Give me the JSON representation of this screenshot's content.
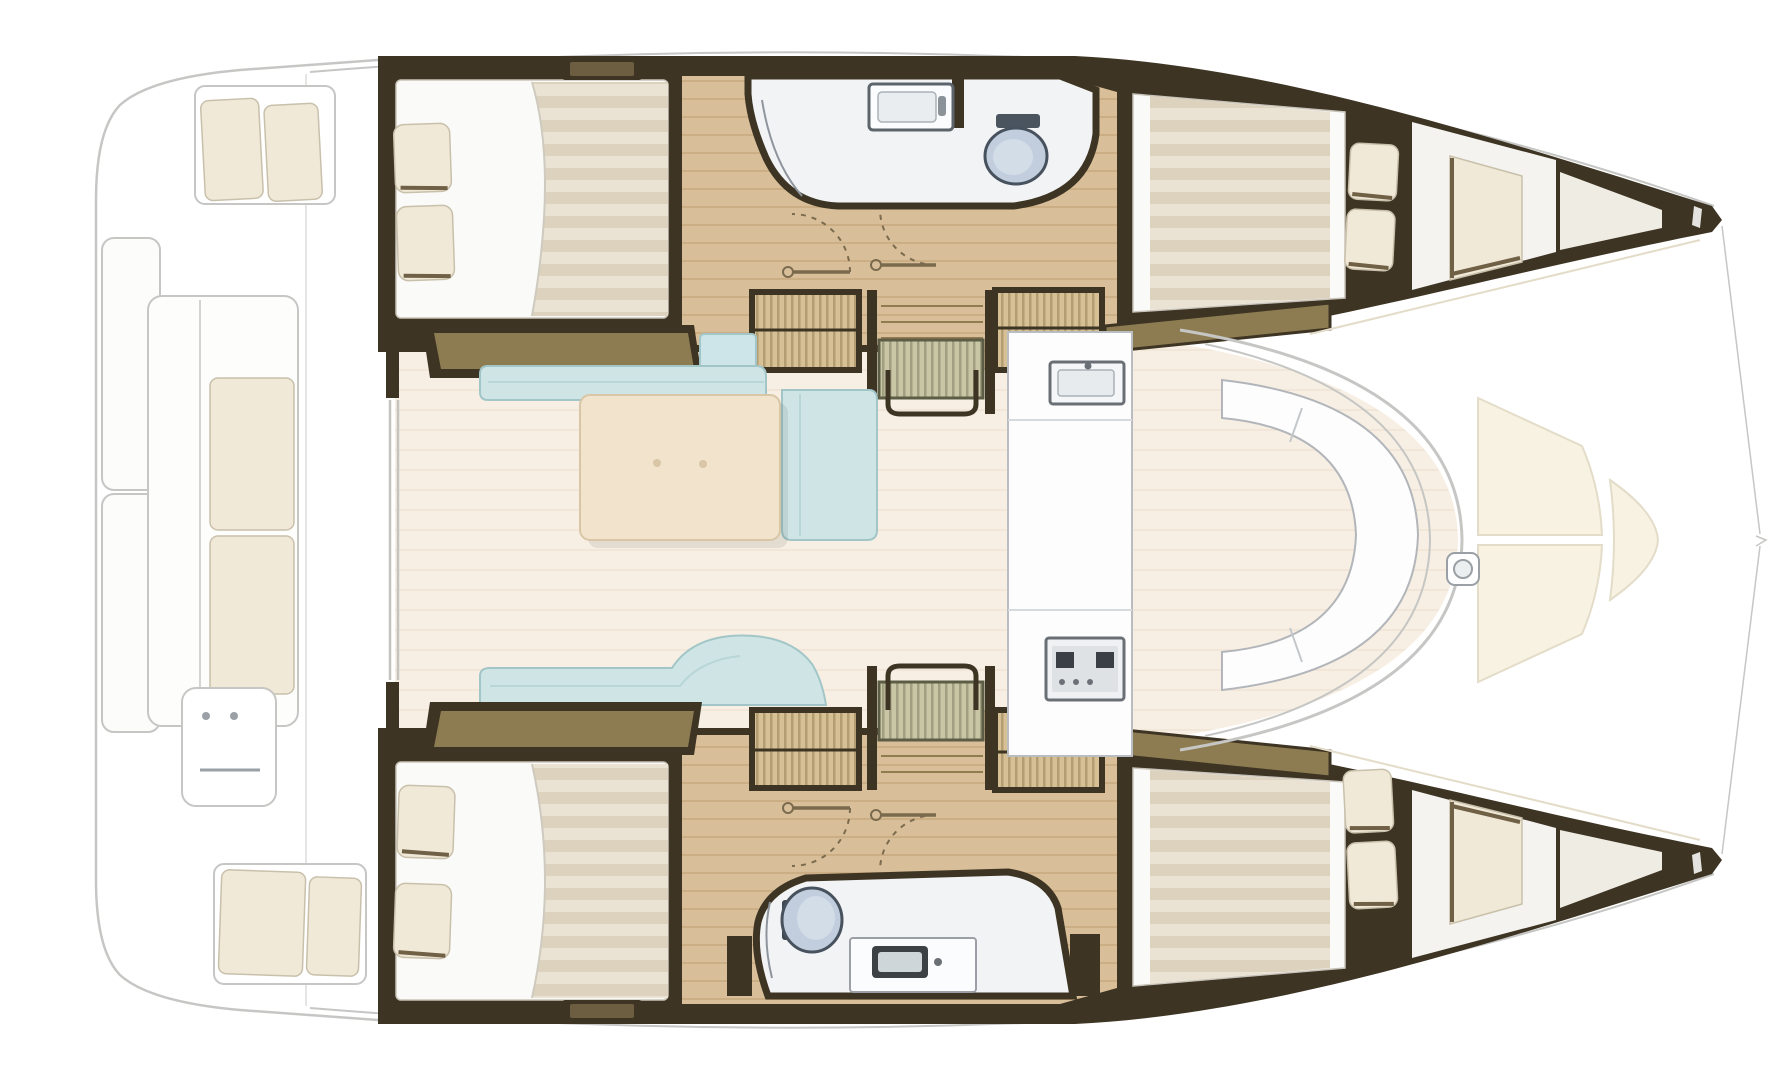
{
  "canvas": {
    "width": 1792,
    "height": 1080
  },
  "document_type": "catamaran-interior-floorplan",
  "visible_text": [],
  "palette": {
    "background": "#ffffff",
    "ghost_line": "#c6c6c4",
    "ghost_fill": "#fcfcfb",
    "cushion_cream": "#f1e9d7",
    "cushion_line": "#c9c0ab",
    "cushion_shadow": "#6f6046",
    "dark_wall": "#3e3423",
    "wall_mid": "#6d5e41",
    "khaki": "#8d7c52",
    "wood": "#d9bf99",
    "wood_line": "#cbae83",
    "wood_pale": "#efece4",
    "mattress": "#eae3d4",
    "mattress_stripe": "#ddd2bd",
    "bed_white": "#fafaf8",
    "bath_floor": "#f2f3f5",
    "bath_line": "#8e959c",
    "toilet_fill": "#c2cedd",
    "toilet_inner": "#d3dde8",
    "toilet_line": "#47525e",
    "aqua": "#cfe5e5",
    "aqua_light": "#cde4e8",
    "aqua_line": "#a2c6c7",
    "saloon_floor": "#f7efe3",
    "floor_line": "#efe4d4",
    "table_fill": "#f1e3cc",
    "table_line": "#d9c6a7",
    "hatch_fill": "#d7c094",
    "hatch_line": "#907a50",
    "steps_fill": "#c8c6a4",
    "steps_line": "#85856a",
    "deck_panel": "#f7f2e2",
    "deck_line": "#e3dcc8",
    "gray_line": "#9aa0a5",
    "white": "#fdfdfd"
  },
  "counts": {
    "cabins": 4,
    "bathrooms": 2,
    "toilets": 2,
    "sinks_bath": 2,
    "double_beds": 4,
    "pillows": 8,
    "stairways": 2,
    "door_swings": 4
  }
}
